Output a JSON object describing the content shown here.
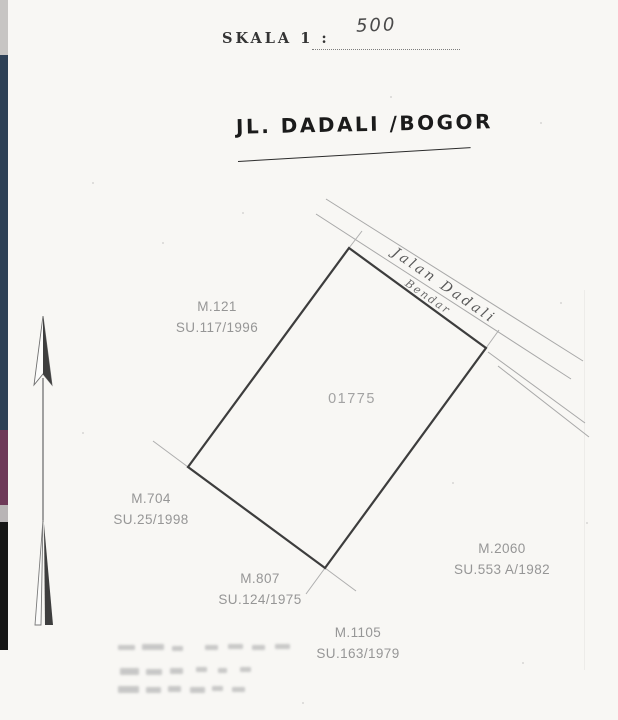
{
  "scale": {
    "label": "SKALA 1 :",
    "value": "500"
  },
  "handwritten_title": "JL. DADALI /BOGOR",
  "road": {
    "name": "Jalan Dadali",
    "secondary": "Bendar"
  },
  "parcel": {
    "number": "01775"
  },
  "adjacent_parcels": [
    {
      "m": "M.121",
      "su": "SU.117/1996"
    },
    {
      "m": "M.704",
      "su": "SU.25/1998"
    },
    {
      "m": "M.807",
      "su": "SU.124/1975"
    },
    {
      "m": "M.1105",
      "su": "SU.163/1979"
    },
    {
      "m": "M.2060",
      "su": "SU.553 A/1982"
    }
  ],
  "colors": {
    "paper": "#f8f7f4",
    "parcel_line": "#3d3d3d",
    "road_line": "#a8a8a8",
    "label_gray": "#969696",
    "edge_strip_navy": "#2e4156",
    "edge_strip_plum": "#6e3a58",
    "edge_strip_black": "#161616",
    "edge_strip_gray": "#c7c5c3"
  }
}
